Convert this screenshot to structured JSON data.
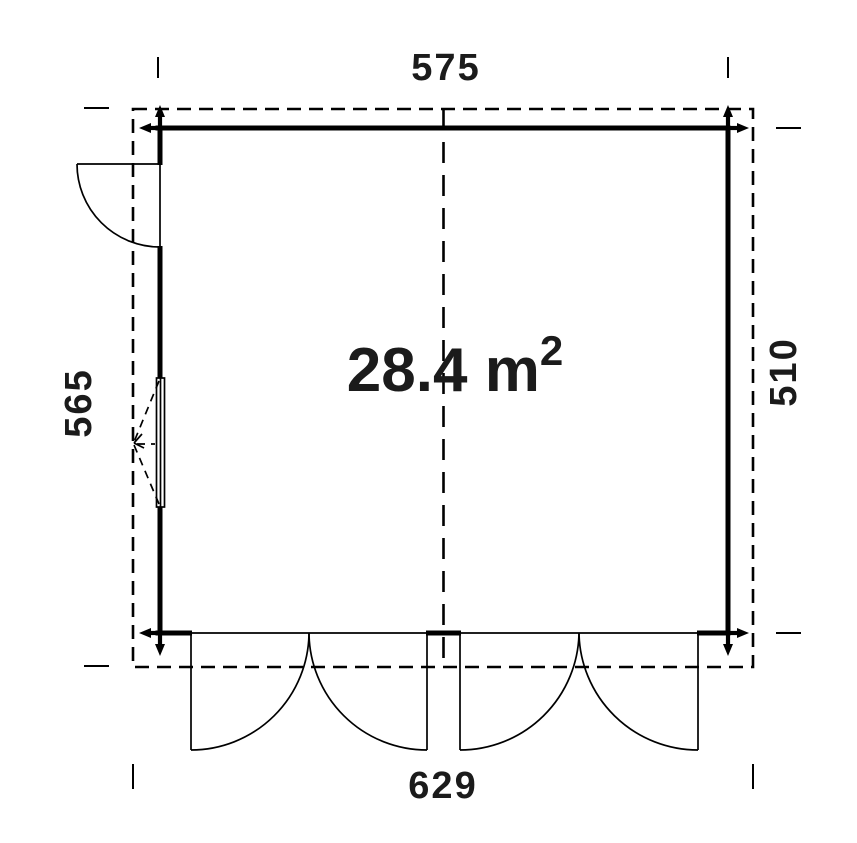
{
  "diagram": {
    "type": "floor-plan",
    "area_label": {
      "text": "28.4 m",
      "superscript": "2",
      "full": "28.4 m²"
    },
    "dimensions": {
      "top_width": "575",
      "bottom_width": "629",
      "left_height": "565",
      "right_height": "510"
    },
    "symbols": {
      "roof_outline": "dashed-overhang-outline",
      "center_line": "dashed-axis-line",
      "entrance_door": "single-door-swing",
      "window": "window-with-opening-arrow",
      "front_doors": "two-double-door-swings"
    }
  },
  "colors": {
    "line": "#000000",
    "text": "#1b1b1b",
    "background": "#ffffff"
  }
}
